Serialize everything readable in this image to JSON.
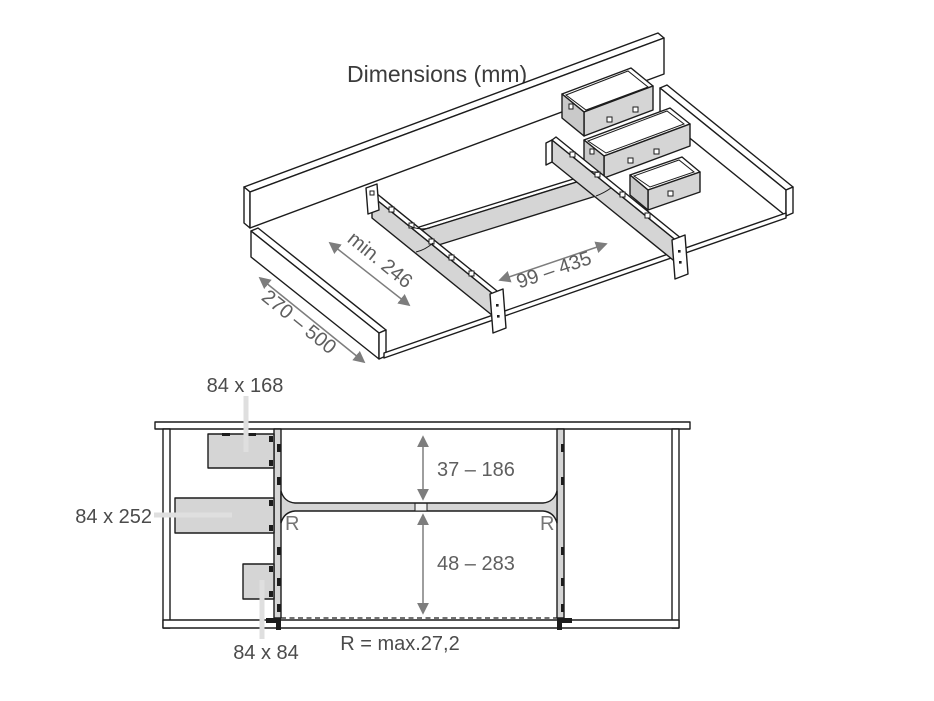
{
  "title": "Dimensions (mm)",
  "iso_view": {
    "dim_depth_left": "min. 246",
    "dim_width_center": "99 – 435",
    "dim_front_edge": "270 – 500"
  },
  "plan_view": {
    "insert_medium_label": "84 x 168",
    "insert_large_label": "84 x 252",
    "insert_small_label": "84 x 84",
    "dim_back_compartment": "37 – 186",
    "dim_front_compartment": "48 – 283",
    "radius_left": "R",
    "radius_right": "R",
    "radius_note": "R = max.27,2"
  },
  "colors": {
    "line": "#1c1c1c",
    "divider_gray": "#d5d5d5",
    "dimension_gray": "#7d7d7d",
    "leader_gray": "#dfdfdf",
    "background": "#ffffff"
  }
}
